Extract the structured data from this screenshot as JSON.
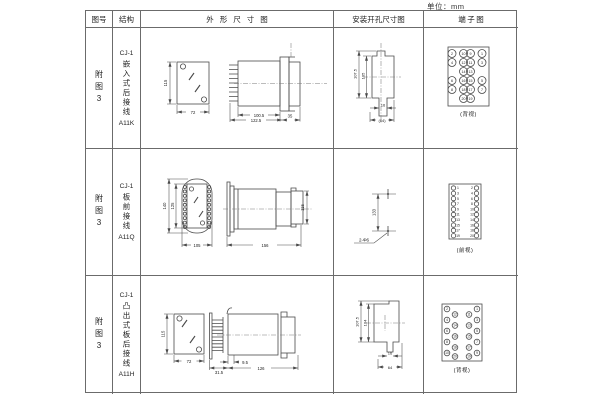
{
  "units_label": "单位：mm",
  "colors": {
    "line": "#4a4a4a",
    "border": "#6b6b6b",
    "text": "#222222"
  },
  "header": {
    "fig_no": "图号",
    "structure": "结构",
    "outline": "外形尺寸图",
    "install": "安装开孔尺寸图",
    "terminal": "端子图"
  },
  "rows": [
    {
      "fig_no": "附图3",
      "structure": {
        "model": "CJ-1",
        "desc": "嵌入式后接线",
        "code": "A11K"
      },
      "outline": {
        "front_h": "115",
        "front_w": "72",
        "body": "100.5",
        "overall": "122.5",
        "rear": "35"
      },
      "install": {
        "outer_h": "107.5",
        "inner_h": "105",
        "slot_w": "16",
        "bottom_w": "(64)"
      },
      "terminal": {
        "view": "(背视)",
        "pins_grid": [
          [
            "2",
            "10",
            "9",
            "1"
          ],
          [
            "4",
            "12",
            "11",
            "3"
          ],
          [
            "",
            "14",
            "13",
            ""
          ],
          [
            "6",
            "16",
            "15",
            "5"
          ],
          [
            "8",
            "18",
            "17",
            "7"
          ],
          [
            "",
            "20",
            "19",
            ""
          ]
        ]
      }
    },
    {
      "fig_no": "附图3",
      "structure": {
        "model": "CJ-1",
        "desc": "板前接线",
        "code": "A11Q"
      },
      "outline": {
        "front_outer_h": "140",
        "front_inner_h": "125",
        "front_w": "105",
        "side_len": "156",
        "side_h": "115"
      },
      "install": {
        "span": "133",
        "holes": "2-Φ6"
      },
      "terminal": {
        "view": "(前视)",
        "left_pins": [
          "1",
          "3",
          "5",
          "7",
          "9",
          "11",
          "13",
          "15",
          "17",
          "19"
        ],
        "right_pins": [
          "2",
          "4",
          "6",
          "8",
          "10",
          "12",
          "14",
          "16",
          "18",
          "20"
        ]
      }
    },
    {
      "fig_no": "附图3",
      "structure": {
        "model": "CJ-1",
        "desc": "凸出式板后接线",
        "code": "A11H"
      },
      "outline": {
        "front_h": "115",
        "front_w": "72",
        "pin_depth": "31.5",
        "offset": "9.5",
        "body_len": "126"
      },
      "install": {
        "outer_h": "107.5",
        "inner_h": "104",
        "slot_w": "16",
        "bottom_w": "64"
      },
      "terminal": {
        "view": "(背视)",
        "left_outer": [
          "2",
          "4",
          "6",
          "8",
          "10"
        ],
        "left_inner": [
          "12",
          "14",
          "16",
          "18",
          "20"
        ],
        "right_inner": [
          "11",
          "13",
          "15",
          "17",
          "19"
        ],
        "right_outer": [
          "1",
          "3",
          "5",
          "7",
          "9"
        ]
      }
    }
  ]
}
